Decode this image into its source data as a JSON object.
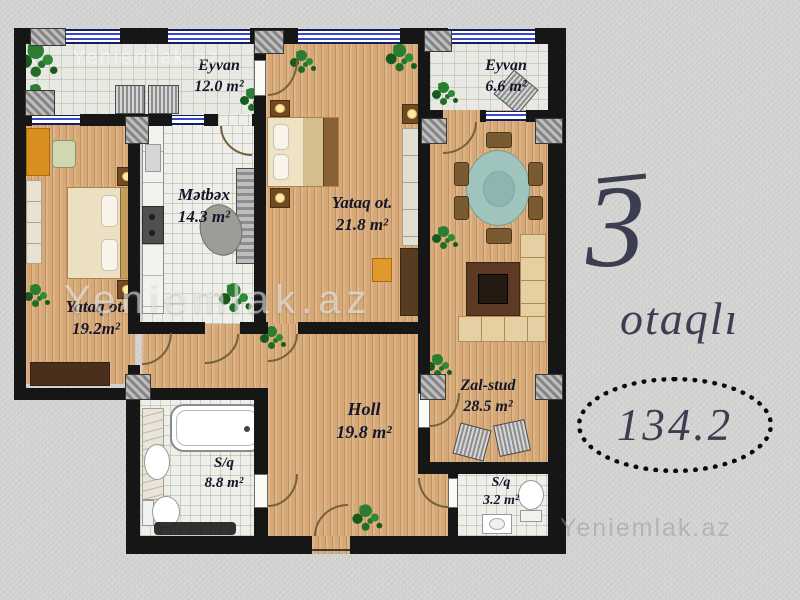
{
  "plan": {
    "rooms": [
      {
        "id": "eyvan-left",
        "name": "Eyvan",
        "area": "12.0 m²"
      },
      {
        "id": "eyvan-right",
        "name": "Eyvan",
        "area": "6.6 m²"
      },
      {
        "id": "yataq-left",
        "name": "Yataq ot.",
        "area": "19.2m²"
      },
      {
        "id": "metbex",
        "name": "Mətbəx",
        "area": "14.3 m²"
      },
      {
        "id": "yataq-center",
        "name": "Yataq ot.",
        "area": "21.8 m²"
      },
      {
        "id": "zal-stud",
        "name": "Zal-stud",
        "area": "28.5 m²"
      },
      {
        "id": "holl",
        "name": "Holl",
        "area": "19.8 m²"
      },
      {
        "id": "sq-large",
        "name": "S/q",
        "area": "8.8 m²"
      },
      {
        "id": "sq-small",
        "name": "S/q",
        "area": "3.2 m²"
      }
    ]
  },
  "side_info": {
    "rooms_count": "3",
    "rooms_word": "otaqlı",
    "total_area": "134.2"
  },
  "watermark": {
    "text": "Yeniemlak.az"
  },
  "colors": {
    "wall": "#161616",
    "wood_floor": "#d6a977",
    "tile_floor": "#eeefe9",
    "window_blue": "#3748c8",
    "label_text": "#15152b",
    "side_text": "#3d3d52",
    "background": "#d5d5d3"
  }
}
